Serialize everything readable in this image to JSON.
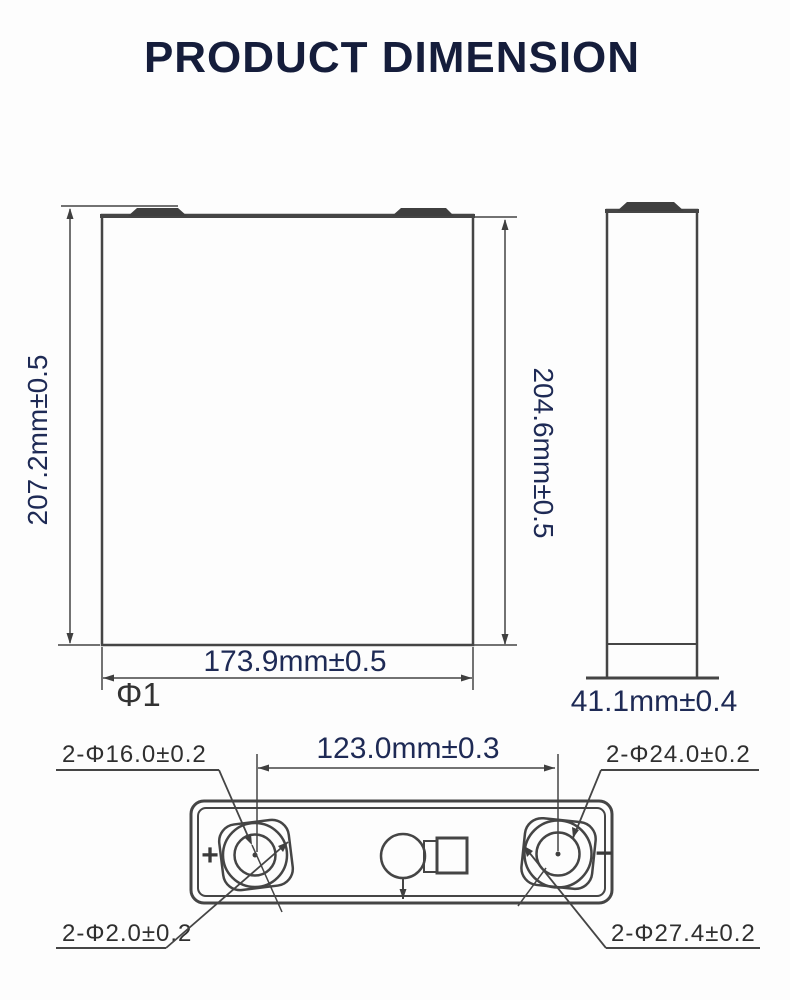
{
  "title": "PRODUCT DIMENSION",
  "colors": {
    "drawing_line": "#454545",
    "dimension_text": "#1e2a55",
    "label_text": "#2f2f2f",
    "title_text": "#151d3b",
    "background": "#ffffff"
  },
  "front_view": {
    "overall_height": "207.2mm±0.5",
    "body_height": "204.6mm±0.5",
    "width": "173.9mm±0.5",
    "flatness_label": "Φ1"
  },
  "side_view": {
    "thickness": "41.1mm±0.4"
  },
  "top_view": {
    "terminal_pitch": "123.0mm±0.3",
    "label_top_left": "2-Φ16.0±0.2",
    "label_top_right": "2-Φ24.0±0.2",
    "label_bottom_left": "2-Φ2.0±0.2",
    "label_bottom_right": "2-Φ27.4±0.2",
    "positive_mark": "+",
    "negative_mark": "−"
  }
}
